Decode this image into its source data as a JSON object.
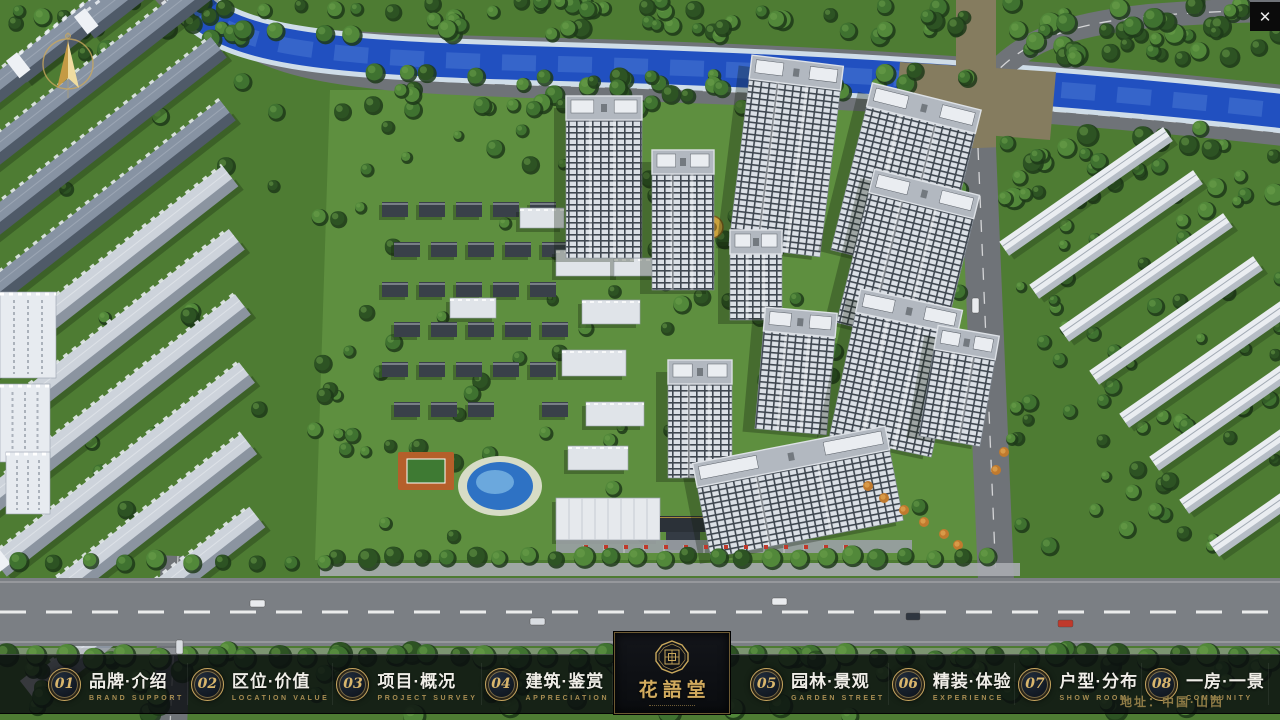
{
  "window": {
    "close_glyph": "✕"
  },
  "nav": {
    "items": [
      {
        "num": "01",
        "label": "品牌·介绍",
        "sub": "BRAND SUPPORT"
      },
      {
        "num": "02",
        "label": "区位·价值",
        "sub": "LOCATION VALUE"
      },
      {
        "num": "03",
        "label": "项目·概况",
        "sub": "PROJECT SURVEY"
      },
      {
        "num": "04",
        "label": "建筑·鉴赏",
        "sub": "APPRECIATION"
      },
      {
        "num": "05",
        "label": "园林·景观",
        "sub": "GARDEN STREET"
      },
      {
        "num": "06",
        "label": "精装·体验",
        "sub": "EXPERIENCE"
      },
      {
        "num": "07",
        "label": "户型·分布",
        "sub": "SHOW ROOM"
      },
      {
        "num": "08",
        "label": "一房·一景",
        "sub": "COMMUNITY"
      }
    ],
    "logo_title": "花語堂",
    "address": "地址：中国·山西"
  },
  "scene": {
    "palette": {
      "grass": "#4e7c33",
      "grassLight": "#5f9040",
      "treeDark": "#1d3a19",
      "tree1": "#2d5323",
      "tree2": "#3f7230",
      "tree3": "#52883a",
      "treeHi": "#6ea24c",
      "road": "#6f7378",
      "roadLight": "#a9acb0",
      "roadDark": "#7b7f84",
      "khaki": "#857c5f",
      "river": "#2150c0",
      "riverLight": "#4f7fd8",
      "bank": "#cfdde8",
      "roof": "#b2b8c0",
      "roofEdge": "#dde1e6",
      "slabTopD": "#8793a3",
      "slabSideD": "#4f5a68",
      "slabTopL": "#cdd3db",
      "slabSideL": "#8b94a0",
      "whTop": "#eaedf1",
      "whSide": "#b6bdc6",
      "houseRoof": "#394049",
      "houseTrim": "#ccd2d9",
      "white": "#e9ecf0",
      "shadow": "#0f1e0b",
      "poolDeck": "#d7dcc6",
      "poolWater": "#2e72c4",
      "poolLight": "#7ab5e4",
      "court": "#b55f2a",
      "courtIn": "#3e7a33",
      "gold": "#caa23c",
      "flag": "#c0392b"
    },
    "riverPath": "M186,-10 C210,50 330,58 560,64 C820,71 1060,86 1290,112",
    "roadAbove": "M158,-10 C186,38 330,40 560,46 C820,53 1062,68 1292,94",
    "roadBelow": "M208,-10 C230,70 340,80 566,86 C824,93 1062,108 1292,134",
    "curveTR": "M986,84 C1020,40 1070,24 1150,16 C1200,12 1250,10 1290,10",
    "vertTop": "M976,-10 L976,150",
    "vertBottom": "M978,148 L996,580",
    "leftRoad": "M178,556 L170,726",
    "intersection": "900,62 1056,72 1050,140 894,128",
    "leftSlabs": [
      [
        -40,
        120,
        300,
        0
      ],
      [
        20,
        74,
        260,
        0
      ],
      [
        88,
        30,
        220,
        0
      ],
      [
        -45,
        186,
        320,
        0
      ],
      [
        -40,
        252,
        330,
        0
      ],
      [
        -35,
        318,
        335,
        0
      ],
      [
        -30,
        382,
        332,
        1
      ],
      [
        -22,
        444,
        330,
        1
      ],
      [
        -12,
        506,
        325,
        1
      ],
      [
        0,
        568,
        315,
        1
      ],
      [
        14,
        630,
        300,
        1
      ],
      [
        34,
        694,
        285,
        1
      ]
    ],
    "leftTowers": [
      [
        0,
        292,
        56,
        86
      ],
      [
        0,
        384,
        50,
        78
      ],
      [
        6,
        452,
        44,
        62
      ]
    ],
    "warehouses": [
      [
        1005,
        250
      ],
      [
        1035,
        293
      ],
      [
        1065,
        336
      ],
      [
        1095,
        379
      ],
      [
        1125,
        422
      ],
      [
        1155,
        465
      ],
      [
        1185,
        508
      ],
      [
        1215,
        551
      ]
    ],
    "whLen": 200,
    "houses": {
      "x0": 382,
      "y0": 202,
      "cols": 5,
      "rows": 7,
      "dx": 37,
      "dy": 40,
      "w": 26,
      "h": 15,
      "skips": [
        28,
        30,
        31,
        32,
        33,
        34
      ]
    },
    "midSlabs": [
      [
        556,
        250,
        64,
        26
      ],
      [
        582,
        300,
        58,
        24
      ],
      [
        562,
        350,
        64,
        26
      ],
      [
        586,
        402,
        58,
        24
      ],
      [
        568,
        446,
        60,
        24
      ],
      [
        450,
        298,
        46,
        20
      ],
      [
        614,
        258,
        42,
        18
      ],
      [
        520,
        208,
        44,
        20
      ]
    ],
    "towers": [
      [
        566,
        96,
        76,
        162,
        0
      ],
      [
        652,
        150,
        62,
        140,
        0
      ],
      [
        740,
        60,
        92,
        192,
        7
      ],
      [
        850,
        94,
        112,
        172,
        14
      ],
      [
        854,
        180,
        108,
        158,
        14
      ],
      [
        730,
        230,
        52,
        90,
        0
      ],
      [
        760,
        310,
        72,
        122,
        5
      ],
      [
        844,
        298,
        104,
        150,
        12
      ],
      [
        668,
        360,
        64,
        118,
        0
      ],
      [
        928,
        330,
        62,
        112,
        10
      ],
      [
        700,
        444,
        196,
        96,
        -11
      ]
    ],
    "treeZones": [
      [
        250,
        0,
        720,
        36,
        55,
        5,
        9
      ],
      [
        1000,
        0,
        280,
        58,
        42,
        5,
        10
      ],
      [
        330,
        70,
        640,
        44,
        55,
        5,
        9
      ],
      [
        0,
        0,
        250,
        55,
        28,
        5,
        9
      ],
      [
        1004,
        126,
        276,
        72,
        34,
        5,
        10
      ],
      [
        1010,
        198,
        270,
        350,
        60,
        4,
        8
      ],
      [
        336,
        102,
        628,
        448,
        120,
        4,
        8
      ],
      [
        0,
        62,
        330,
        495,
        26,
        4,
        8
      ]
    ],
    "treeZonesPost": [
      [
        0,
        648,
        1280,
        68,
        60,
        6,
        11
      ]
    ],
    "streetRows": [
      [
        338,
        1012,
        27,
        557,
        8
      ],
      [
        6,
        1274,
        30,
        656,
        9
      ],
      [
        20,
        330,
        34,
        560,
        7
      ]
    ],
    "cars": [
      [
        250,
        600,
        15,
        7,
        "#e9ebee"
      ],
      [
        530,
        618,
        15,
        7,
        "#d9dde2"
      ],
      [
        772,
        598,
        15,
        7,
        "#e9ebee"
      ],
      [
        1058,
        620,
        15,
        7,
        "#c0392b"
      ],
      [
        906,
        613,
        14,
        7,
        "#2f3640"
      ],
      [
        972,
        298,
        7,
        15,
        "#e9ebee"
      ],
      [
        176,
        640,
        7,
        14,
        "#d9dde2"
      ]
    ],
    "flags": {
      "x0": 584,
      "x1": 844,
      "step": 20,
      "y": 545
    },
    "orangeTrees": [
      [
        884,
        498
      ],
      [
        904,
        510
      ],
      [
        924,
        522
      ],
      [
        944,
        534
      ],
      [
        868,
        486
      ],
      [
        958,
        545
      ],
      [
        996,
        470
      ],
      [
        1004,
        452
      ]
    ],
    "pool": {
      "cx": 500,
      "cy": 486
    },
    "court": {
      "x": 398,
      "y": 452,
      "w": 56,
      "h": 38
    },
    "gate": {
      "x": 660,
      "y": 516
    },
    "sales": {
      "x": 556,
      "y": 498,
      "w": 104,
      "h": 42
    },
    "plaza": {
      "x": 556,
      "y": 540,
      "w": 356,
      "h": 13
    },
    "feature": {
      "cx": 712,
      "cy": 227
    }
  }
}
